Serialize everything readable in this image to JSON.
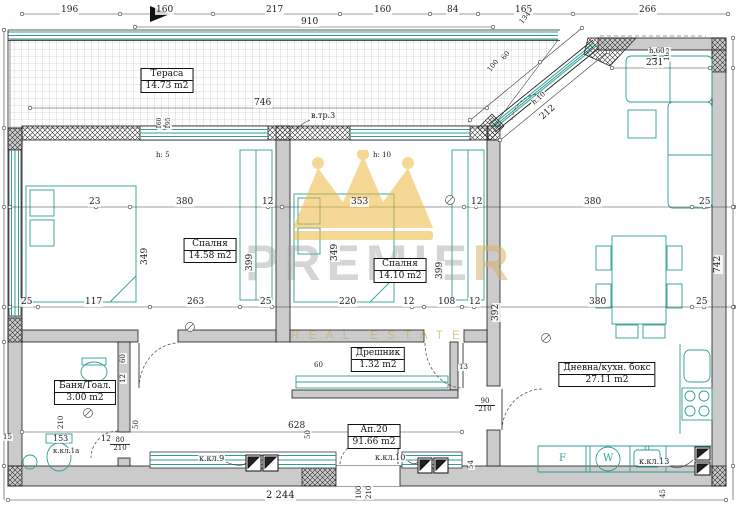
{
  "colors": {
    "teal": "#2f9e95",
    "wall_gray": "#cbcbcb",
    "gold": "#e8b33b",
    "watermark_text": "#bdbdbd"
  },
  "watermark": {
    "part1": "PREMIE",
    "part2": "R",
    "subtitle": "REAL ESTATE"
  },
  "rooms": {
    "terrace": {
      "name": "Тераса",
      "area": "14.73 m2"
    },
    "bedroom1": {
      "name": "Спалня",
      "area": "14.58 m2"
    },
    "bedroom2": {
      "name": "Спалня",
      "area": "14.10 m2"
    },
    "living": {
      "name": "Дневна/кухн. бокс",
      "area": "27.11 m2"
    },
    "closet": {
      "name": "Дрешник",
      "area": "1.32 m2"
    },
    "bath": {
      "name": "Баня/Тоал.",
      "area": "3.00 m2"
    },
    "apartment": {
      "name": "Ап.20",
      "area": "91.66 m2"
    }
  },
  "dims": {
    "top": [
      "196",
      "160",
      "217",
      "160",
      "84",
      "165",
      "266"
    ],
    "overall_top": "910",
    "terrace_width": "746",
    "diag": [
      "134",
      "60",
      "100"
    ],
    "right_vert": [
      "160",
      "165"
    ],
    "right_top": "231",
    "mid": [
      "23",
      "380",
      "12",
      "353",
      "12",
      "380",
      "25"
    ],
    "low": [
      "25",
      "117",
      "263",
      "25",
      "220",
      "12",
      "108",
      "12",
      "380",
      "25"
    ],
    "vert": {
      "a399": "399",
      "b399": "399",
      "a349": "349",
      "b349": "349",
      "v742": "742",
      "v392": "392"
    },
    "bottom": {
      "w628": "628",
      "h50": "50",
      "total": "2 244"
    },
    "bath": {
      "w153": "153",
      "g12": "12",
      "e15": "15",
      "d210": "210",
      "h50": "50",
      "s60": "60",
      "s12": "12"
    },
    "misc": {
      "closet60": "60",
      "closet13": "13",
      "hall54": "54",
      "k45": "45",
      "t160": "160",
      "t195": "195"
    }
  },
  "doors": {
    "living": {
      "w": "90",
      "h": "210"
    },
    "bath": {
      "w": "80",
      "h": "210"
    },
    "entry": {
      "w": "100",
      "h": "210"
    }
  },
  "annotations": {
    "vtr3": "в.тр.3",
    "h5": "h: 5",
    "h10": "h: 10",
    "h60": "h.60",
    "hd10": "h.10",
    "d212": "212",
    "kkl9": "к.кл.9",
    "kkl10": "к.кл.10",
    "kkl13": "к.кл.13",
    "kkl1a": "к.кл.1а",
    "fridge": "F",
    "washer": "W"
  }
}
